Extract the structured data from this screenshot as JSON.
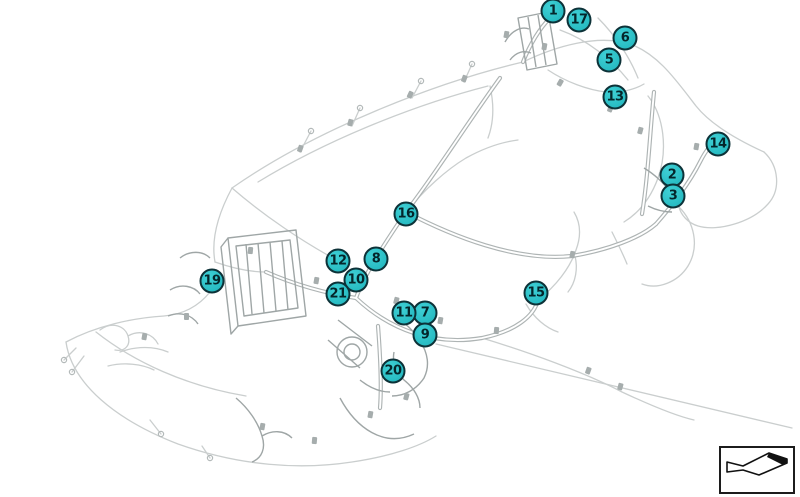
{
  "diagram": {
    "kind": "vehicle-wiring-harness-parts-diagram",
    "background": "#ffffff",
    "callout_style": {
      "fill_light": "#3fd0d5",
      "fill_dark": "#1fb4bc",
      "border_color": "#0d3238",
      "text_color": "#04262b"
    },
    "line_art_colors": {
      "light": "#cacece",
      "medium": "#a9b0b0",
      "cluster": "#9fa6a6",
      "blob": "#a6adad"
    },
    "callouts": [
      {
        "label": "1",
        "x": 553,
        "y": 11
      },
      {
        "label": "2",
        "x": 672,
        "y": 175
      },
      {
        "label": "3",
        "x": 673,
        "y": 196
      },
      {
        "label": "5",
        "x": 609,
        "y": 60
      },
      {
        "label": "6",
        "x": 625,
        "y": 38
      },
      {
        "label": "7",
        "x": 425,
        "y": 313
      },
      {
        "label": "8",
        "x": 376,
        "y": 259
      },
      {
        "label": "9",
        "x": 425,
        "y": 335
      },
      {
        "label": "10",
        "x": 356,
        "y": 280
      },
      {
        "label": "11",
        "x": 404,
        "y": 313
      },
      {
        "label": "12",
        "x": 338,
        "y": 261
      },
      {
        "label": "13",
        "x": 615,
        "y": 97
      },
      {
        "label": "14",
        "x": 718,
        "y": 144
      },
      {
        "label": "15",
        "x": 536,
        "y": 293
      },
      {
        "label": "16",
        "x": 406,
        "y": 214
      },
      {
        "label": "17",
        "x": 579,
        "y": 20
      },
      {
        "label": "19",
        "x": 212,
        "y": 281
      },
      {
        "label": "20",
        "x": 393,
        "y": 371
      },
      {
        "label": "21",
        "x": 338,
        "y": 294
      }
    ],
    "direction_indicator": {
      "name": "driving-direction-arrow",
      "border_color": "#1c1c1c",
      "arrow_color": "#111111"
    }
  }
}
